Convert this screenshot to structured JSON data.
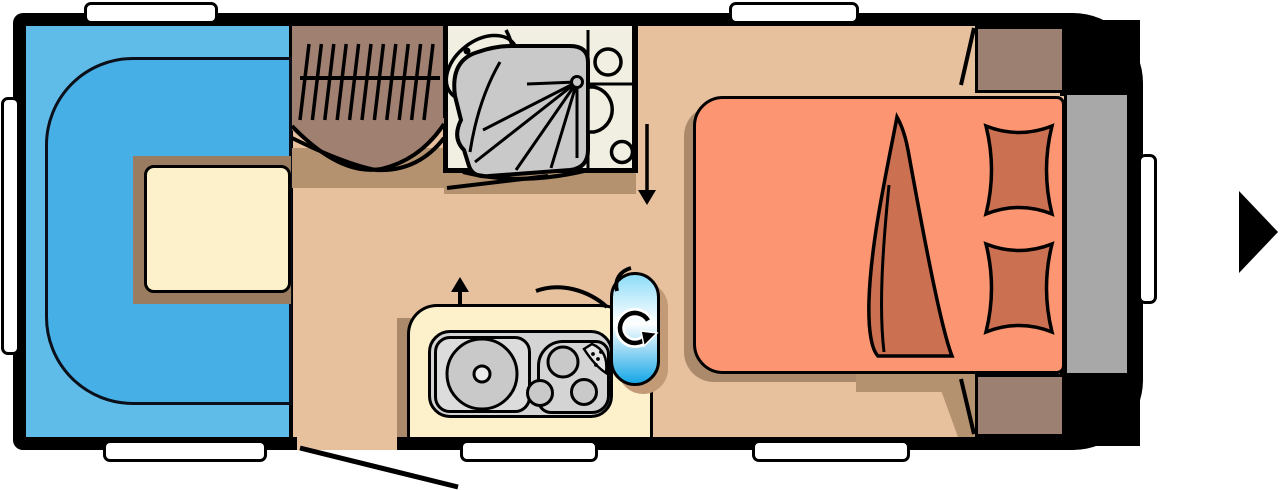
{
  "document": {
    "type": "caravan floor plan diagram",
    "view": "top-down layout, hitch side on the right indicated by arrow"
  },
  "palette": {
    "page": "#ffffff",
    "wall": "#000000",
    "floor": "#e7c09e",
    "floor_shadow": "#ab8a6b",
    "floor_shadow_light": "#b5926f",
    "lounge_back": "#5fbce9",
    "lounge_cushion": "#45afe6",
    "table_top": "#fdf1cb",
    "table_shadow": "#9a7d60",
    "wardrobe": "#a08070",
    "cabinet": "#9c8173",
    "bath_floor": "#f1efe2",
    "shower_gray": "#c9c9c9",
    "fixture_gray": "#d4d4d4",
    "fixture_gray_light": "#dcdcdc",
    "burner_gray": "#c9c9c9",
    "bed": "#fc9672",
    "bedding": "#cc7052",
    "headboard": "#a8a8a8",
    "capsule_top": "#8edcf8",
    "capsule_bottom": "#17a7e6",
    "window": "#ffffff"
  },
  "zones": {
    "lounge": "U-shaped front lounge with dinette table",
    "wardrobe": "wardrobe with hanging rail",
    "washroom": "washroom with corner basin, shower and toilet",
    "kitchen": "kitchen block with round sink and three-burner hob",
    "bedroom": "double bed with duvet and two pillows",
    "rear_cabinets": "rear storage cabinets with hinged doors",
    "headboard": "head-end shelf behind bed"
  },
  "indicators": {
    "entry_door": "entrance door opening with swing line, bottom wall",
    "washroom_door": "washroom door swing line",
    "walk_arrow_down": "downward arrow beside washroom",
    "walk_arrow_up": "upward arrow above kitchen block",
    "direction_arrow": "solid black arrow pointing right outside the body",
    "swivel_fixture": "blue capsule with rotation arrow between kitchen and bed"
  },
  "counts": {
    "top_windows": 2,
    "bottom_windows": 3,
    "side_windows": 2,
    "pillows": 2,
    "hob_burners": 3,
    "hanger_hooks": 11
  }
}
